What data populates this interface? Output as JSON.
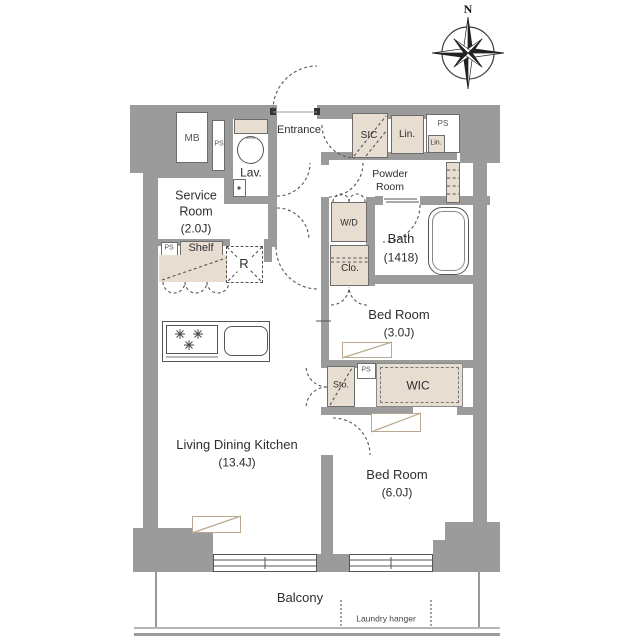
{
  "labels": {
    "mb": "MB",
    "ps": "PS",
    "entrance": "Entrance",
    "lav": "Lav.",
    "sic": "SIC",
    "lin": "Lin.",
    "service_room": "Service Room",
    "service_size": "(2.0J)",
    "powder_room": "Powder Room",
    "wd": "W/D",
    "bath": "Bath",
    "bath_size": "(1418)",
    "shelf": "Shelf",
    "clo": "Clo.",
    "refrigerator": "R",
    "bedroom": "Bed Room",
    "bedroom3_size": "(3.0J)",
    "bedroom6_size": "(6.0J)",
    "sto": "Sto.",
    "wic": "WIC",
    "ldk": "Living Dining Kitchen",
    "ldk_size": "(13.4J)",
    "balcony": "Balcony",
    "laundry_hanger": "Laundry hanger",
    "north": "N"
  },
  "colors": {
    "wall": "#9b9b9b",
    "fixture_fill": "#e8ddd1",
    "line": "#555555",
    "symbol_border": "#b7a88f"
  }
}
